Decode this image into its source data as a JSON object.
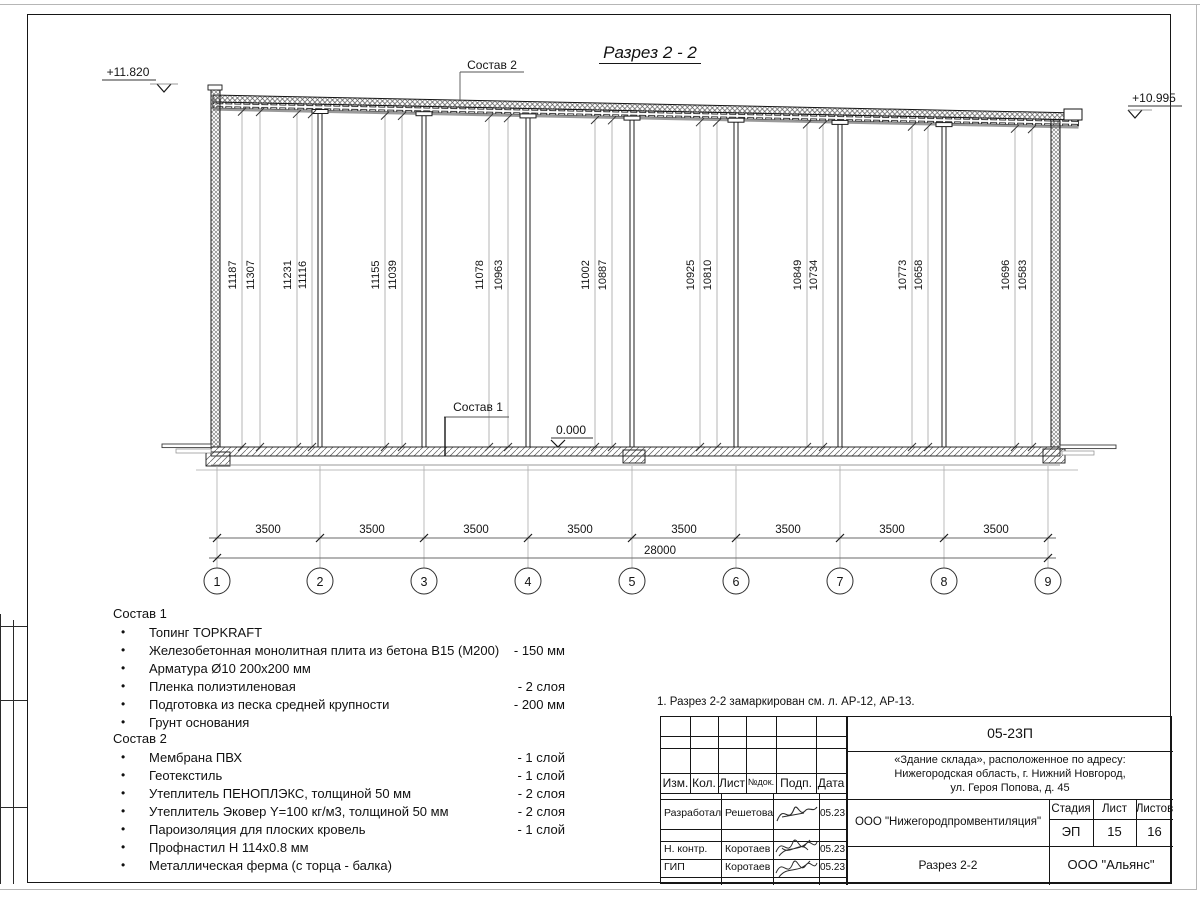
{
  "title": "Разрез 2 - 2",
  "elevations": {
    "left": "+11.820",
    "right": "+10.995",
    "zero": "0.000"
  },
  "leaders": {
    "sostav1": "Состав 1",
    "sostav2": "Состав 2"
  },
  "drawing": {
    "height_dims": [
      "11187",
      "11307",
      "11231",
      "11116",
      "11155",
      "11039",
      "11078",
      "10963",
      "11002",
      "10887",
      "10925",
      "10810",
      "10849",
      "10734",
      "10773",
      "10658",
      "10696",
      "10583"
    ],
    "bay_dims": [
      "3500",
      "3500",
      "3500",
      "3500",
      "3500",
      "3500",
      "3500",
      "3500"
    ],
    "total_dim": "28000",
    "axes": [
      "1",
      "2",
      "3",
      "4",
      "5",
      "6",
      "7",
      "8",
      "9"
    ]
  },
  "sostav1": {
    "heading": "Состав 1",
    "items": [
      {
        "text": "Топинг TOPKRAFT",
        "value": ""
      },
      {
        "text": "Железобетонная монолитная плита из бетона В15 (М200)",
        "value": "-  150 мм"
      },
      {
        "text": "Арматура Ø10 200х200 мм",
        "value": ""
      },
      {
        "text": "Пленка полиэтиленовая",
        "value": "-  2 слоя"
      },
      {
        "text": "Подготовка из песка средней крупности",
        "value": "- 200 мм"
      },
      {
        "text": "Грунт основания",
        "value": ""
      }
    ]
  },
  "sostav2": {
    "heading": "Состав 2",
    "items": [
      {
        "text": "Мембрана ПВХ",
        "value": "- 1 слой"
      },
      {
        "text": "Геотекстиль",
        "value": "- 1 слой"
      },
      {
        "text": "Утеплитель ПЕНОПЛЭКС, толщиной 50 мм",
        "value": "- 2 слоя"
      },
      {
        "text": "Утеплитель Эковер Y=100 кг/м3, толщиной 50 мм",
        "value": "- 2 слоя"
      },
      {
        "text": "Пароизоляция для плоских кровель",
        "value": "- 1 слой"
      },
      {
        "text": "Профнастил Н 114х0.8 мм",
        "value": ""
      },
      {
        "text": "Металлическая ферма (с торца - балка)",
        "value": ""
      }
    ]
  },
  "note": "1. Разрез 2-2 замаркирован см. л. АР-12, АР-13.",
  "titleblock": {
    "code": "05-23П",
    "object_line1": "«Здание склада», расположенное по адресу:",
    "object_line2": "Нижегородская область, г. Нижний Новгород,",
    "object_line3": "ул. Героя Попова, д. 45",
    "header_cols": [
      "Изм.",
      "Кол.",
      "Лист",
      "№док.",
      "Подп.",
      "Дата"
    ],
    "org": "ООО \"Нижегородпромвентиляция\"",
    "stage_label": "Стадия",
    "sheet_label": "Лист",
    "sheets_label": "Листов",
    "stage": "ЭП",
    "sheet": "15",
    "sheets": "16",
    "rows": [
      {
        "role": "Разработал",
        "name": "Решетова",
        "date": "05.23"
      },
      {
        "role": "Н. контр.",
        "name": "Коротаев",
        "date": "05.23"
      },
      {
        "role": "ГИП",
        "name": "Коротаев",
        "date": "05.23"
      }
    ],
    "doc_title": "Разрез 2-2",
    "company": "ООО \"Альянс\""
  }
}
